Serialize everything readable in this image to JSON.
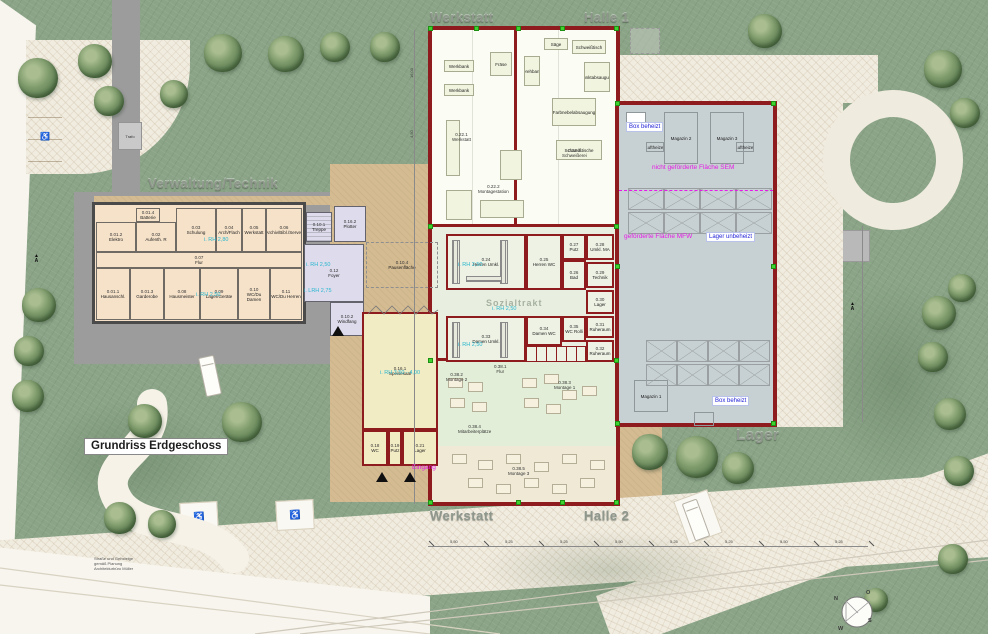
{
  "title": {
    "label": "Grundriss Erdgeschoss"
  },
  "area_labels": {
    "werkstatt_top": "Werkstatt",
    "halle1": "Halle 1",
    "verwaltung": "Verwaltung/Technik",
    "werkstatt_bottom": "Werkstatt",
    "halle2": "Halle 2",
    "lager": "Lager"
  },
  "watermark": {
    "sozialtrakt": "Sozialtrakt"
  },
  "misc": {
    "trafo": "Trafo",
    "section_a": "A"
  },
  "notes": {
    "lines": [
      "Straße und Gehsteige",
      "gemäß Planung",
      "Architekturbüro Müller"
    ]
  },
  "compass": {
    "n": "N",
    "e": "O",
    "s": "S",
    "w": "W"
  },
  "dimensions": {
    "bottom": [
      "5,50",
      "5,25",
      "5,25",
      "5,50",
      "5,25",
      "5,25",
      "5,50",
      "5,25"
    ],
    "left": [
      "16,00",
      "4,50"
    ]
  },
  "colors": {
    "wall_red": "#8e1b1e",
    "wall_gray": "#4a4a4a",
    "magenta": "#e61ae6",
    "annotation_blue": "#2424d8",
    "height_cyan": "#29b6cf",
    "survey_green": "#3ed32f"
  },
  "rooms": {
    "verwaltung": [
      {
        "code": "0.01.4",
        "name": "Batterie",
        "x": 136,
        "y": 208,
        "w": 24,
        "h": 14
      },
      {
        "code": "0.01.2",
        "name": "Elektro",
        "x": 96,
        "y": 222,
        "w": 40,
        "h": 30
      },
      {
        "code": "0.02",
        "name": "Aufenth. R",
        "x": 136,
        "y": 222,
        "w": 40,
        "h": 30
      },
      {
        "code": "0.03",
        "name": "Schulung",
        "x": 176,
        "y": 208,
        "w": 40,
        "h": 44
      },
      {
        "code": "0.04",
        "name": "Arch/Flach",
        "x": 216,
        "y": 208,
        "w": 26,
        "h": 44
      },
      {
        "code": "0.05",
        "name": "Werkstatt",
        "x": 242,
        "y": 208,
        "w": 24,
        "h": 44
      },
      {
        "code": "0.06",
        "name": "Archiv/Bibl./Server",
        "x": 266,
        "y": 208,
        "w": 36,
        "h": 44
      },
      {
        "code": "0.07",
        "name": "Flur",
        "x": 96,
        "y": 252,
        "w": 206,
        "h": 16
      },
      {
        "code": "0.01.1",
        "name": "Hausanschl.",
        "x": 96,
        "y": 268,
        "w": 34,
        "h": 52
      },
      {
        "code": "0.01.3",
        "name": "Garderobe",
        "x": 130,
        "y": 268,
        "w": 34,
        "h": 52
      },
      {
        "code": "0.08",
        "name": "Hausmeister",
        "x": 164,
        "y": 268,
        "w": 36,
        "h": 52
      },
      {
        "code": "0.09",
        "name": "Lager/Geräte",
        "x": 200,
        "y": 268,
        "w": 38,
        "h": 52
      },
      {
        "code": "0.10",
        "name": "WC/Du Damen",
        "x": 238,
        "y": 268,
        "w": 32,
        "h": 52
      },
      {
        "code": "0.11",
        "name": "WC/Du Herren",
        "x": 270,
        "y": 268,
        "w": 32,
        "h": 52
      }
    ],
    "entry": [
      {
        "code": "0.10.1",
        "name": "Treppe",
        "x": 306,
        "y": 212,
        "w": 26,
        "h": 30,
        "cls": "stairs"
      },
      {
        "code": "0.16.2",
        "name": "Plotter",
        "x": 334,
        "y": 206,
        "w": 32,
        "h": 36
      },
      {
        "code": "0.12",
        "name": "Foyer",
        "x": 304,
        "y": 244,
        "w": 60,
        "h": 58
      },
      {
        "code": "0.10.2",
        "name": "Windfang",
        "x": 330,
        "y": 302,
        "w": 34,
        "h": 34
      }
    ],
    "sozialtrakt": [
      {
        "code": "0.24",
        "name": "Herren Umkl.",
        "x": 446,
        "y": 234,
        "w": 80,
        "h": 56
      },
      {
        "code": "0.25",
        "name": "Herren WC",
        "x": 526,
        "y": 234,
        "w": 36,
        "h": 56
      },
      {
        "code": "0.27",
        "name": "Putz",
        "x": 562,
        "y": 234,
        "w": 24,
        "h": 26
      },
      {
        "code": "0.26",
        "name": "Bad",
        "x": 562,
        "y": 260,
        "w": 24,
        "h": 30
      },
      {
        "code": "0.28",
        "name": "Umkl. MA",
        "x": 586,
        "y": 234,
        "w": 28,
        "h": 26
      },
      {
        "code": "0.29",
        "name": "Technik",
        "x": 586,
        "y": 262,
        "w": 28,
        "h": 26
      },
      {
        "code": "0.30",
        "name": "Lager",
        "x": 586,
        "y": 290,
        "w": 28,
        "h": 24
      },
      {
        "code": "0.31",
        "name": "Ruheraum",
        "x": 586,
        "y": 316,
        "w": 28,
        "h": 22
      },
      {
        "code": "0.32",
        "name": "Ruheraum",
        "x": 586,
        "y": 340,
        "w": 28,
        "h": 22
      },
      {
        "code": "0.33",
        "name": "Damen Umkl.",
        "x": 446,
        "y": 316,
        "w": 80,
        "h": 46
      },
      {
        "code": "0.34",
        "name": "Damen WC",
        "x": 526,
        "y": 316,
        "w": 36,
        "h": 30
      },
      {
        "code": "0.35",
        "name": "WC Rolli",
        "x": 562,
        "y": 316,
        "w": 24,
        "h": 26
      },
      {
        "code": "",
        "name": "",
        "x": 526,
        "y": 346,
        "w": 60,
        "h": 16,
        "cls": "stalls"
      }
    ],
    "halle1": [
      {
        "name": "Werkbank",
        "x": 444,
        "y": 60,
        "w": 30,
        "h": 12
      },
      {
        "name": "Werkbank",
        "x": 444,
        "y": 84,
        "w": 30,
        "h": 12
      },
      {
        "name": "Fräse",
        "x": 490,
        "y": 52,
        "w": 22,
        "h": 24
      },
      {
        "name": "Drehbank",
        "x": 524,
        "y": 56,
        "w": 16,
        "h": 30
      },
      {
        "name": "Säge",
        "x": 544,
        "y": 38,
        "w": 24,
        "h": 12
      },
      {
        "name": "Schweißtisch",
        "x": 572,
        "y": 40,
        "w": 34,
        "h": 14
      },
      {
        "name": "Punktabsaugung",
        "x": 584,
        "y": 62,
        "w": 26,
        "h": 30
      },
      {
        "name": "Farbnebelabsaugung",
        "x": 552,
        "y": 98,
        "w": 44,
        "h": 28
      },
      {
        "name": "Schweißtische",
        "x": 556,
        "y": 140,
        "w": 46,
        "h": 20
      },
      {
        "name": "",
        "x": 446,
        "y": 120,
        "w": 14,
        "h": 56
      },
      {
        "name": "",
        "x": 446,
        "y": 190,
        "w": 26,
        "h": 30
      },
      {
        "name": "",
        "x": 500,
        "y": 150,
        "w": 22,
        "h": 30
      },
      {
        "name": "",
        "x": 480,
        "y": 200,
        "w": 44,
        "h": 18
      }
    ],
    "lager": [
      {
        "name": "",
        "x": 626,
        "y": 112,
        "w": 20,
        "h": 20,
        "cls": "white-box"
      },
      {
        "name": "Magazin 2",
        "x": 664,
        "y": 112,
        "w": 34,
        "h": 52
      },
      {
        "name": "Magazin 3",
        "x": 710,
        "y": 112,
        "w": 34,
        "h": 52
      },
      {
        "name": "Luftheizer",
        "x": 646,
        "y": 142,
        "w": 18,
        "h": 10
      },
      {
        "name": "Luftheizer",
        "x": 736,
        "y": 142,
        "w": 18,
        "h": 10
      },
      {
        "name": "Magazin 1",
        "x": 634,
        "y": 380,
        "w": 34,
        "h": 32
      },
      {
        "name": "",
        "x": 694,
        "y": 412,
        "w": 20,
        "h": 14
      }
    ],
    "courtyard": [
      {
        "code": "0.16.1",
        "name": "Speisesaal",
        "x": 362,
        "y": 312,
        "w": 76,
        "h": 118
      },
      {
        "code": "0.18",
        "name": "WC",
        "x": 362,
        "y": 430,
        "w": 26,
        "h": 36
      },
      {
        "code": "0.19",
        "name": "Putz",
        "x": 388,
        "y": 430,
        "w": 14,
        "h": 36
      },
      {
        "code": "0.21",
        "name": "Lager",
        "x": 402,
        "y": 430,
        "w": 36,
        "h": 36
      },
      {
        "code": "0.10.4",
        "name": "Pausenfläche",
        "x": 366,
        "y": 242,
        "w": 72,
        "h": 46,
        "cls": "dashed"
      }
    ]
  },
  "annotations": [
    {
      "text": "Box beheizt",
      "cls": "blue-box",
      "x": 626,
      "y": 122
    },
    {
      "text": "nicht geförderte Fläche SEM",
      "cls": "magenta",
      "x": 652,
      "y": 164
    },
    {
      "text": "geförderte Fläche MFW",
      "cls": "magenta",
      "x": 624,
      "y": 233
    },
    {
      "text": "Lager unbeheizt",
      "cls": "blue-box",
      "x": 706,
      "y": 232
    },
    {
      "text": "Box beheizt",
      "cls": "blue-box",
      "x": 712,
      "y": 396
    },
    {
      "text": "Eingang",
      "cls": "magenta",
      "x": 412,
      "y": 464
    },
    {
      "text": "i. RH 2,80",
      "cls": "cyan",
      "x": 204,
      "y": 237
    },
    {
      "text": "i. RH 2,50",
      "cls": "cyan",
      "x": 196,
      "y": 292
    },
    {
      "text": "i. RH 2,50",
      "cls": "cyan",
      "x": 306,
      "y": 262
    },
    {
      "text": "i. LRH 2,75",
      "cls": "cyan",
      "x": 304,
      "y": 288
    },
    {
      "text": "i. RH 2,50",
      "cls": "cyan",
      "x": 458,
      "y": 262
    },
    {
      "text": "i. RH 2,50",
      "cls": "cyan",
      "x": 458,
      "y": 342
    },
    {
      "text": "i. RH 2,50",
      "cls": "cyan",
      "x": 492,
      "y": 306
    },
    {
      "text": "i. RH 3,50 - 4,00",
      "cls": "cyan",
      "x": 380,
      "y": 370
    },
    {
      "text": "0.22.1\nWerkstatt",
      "cls": "zlabel",
      "x": 452,
      "y": 132
    },
    {
      "text": "0.22.3\nSchweißerei",
      "cls": "zlabel",
      "x": 562,
      "y": 148
    },
    {
      "text": "0.22.2\nMontagestation",
      "cls": "zlabel",
      "x": 478,
      "y": 184
    },
    {
      "text": "0.38.1\nFlur",
      "cls": "zlabel",
      "x": 494,
      "y": 364
    },
    {
      "text": "0.38.2\nMontage 2",
      "cls": "zlabel",
      "x": 446,
      "y": 372
    },
    {
      "text": "0.38.3\nMontage 1",
      "cls": "zlabel",
      "x": 554,
      "y": 380
    },
    {
      "text": "0.38.4\nMitarbeiterplätze",
      "cls": "zlabel",
      "x": 458,
      "y": 424
    },
    {
      "text": "0.38.5\nMontage 3",
      "cls": "zlabel",
      "x": 508,
      "y": 466
    }
  ]
}
